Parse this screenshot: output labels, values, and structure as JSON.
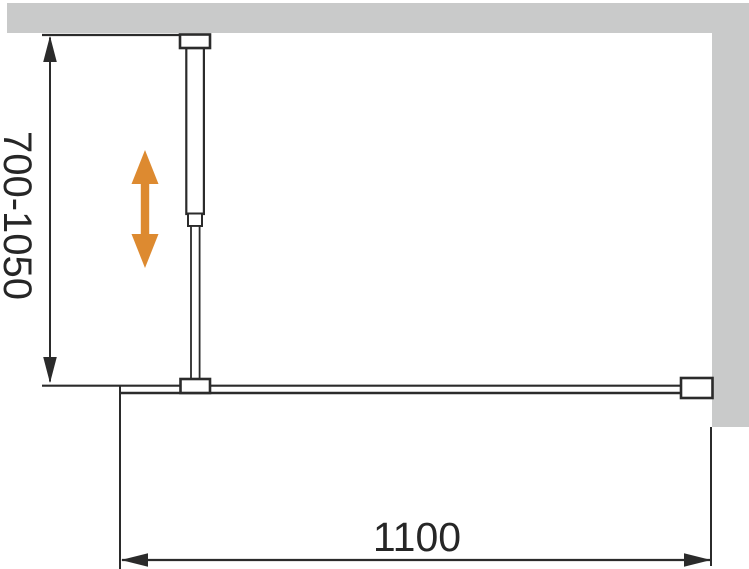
{
  "labels": {
    "bar_length_range": "700-1050",
    "screen_width": "1100"
  },
  "colors": {
    "wall_gray": "#c9caca",
    "line_dark": "#2b2b2b",
    "text_dark": "#262626",
    "arrow_orange": "#dd8a30",
    "background": "#ffffff"
  }
}
